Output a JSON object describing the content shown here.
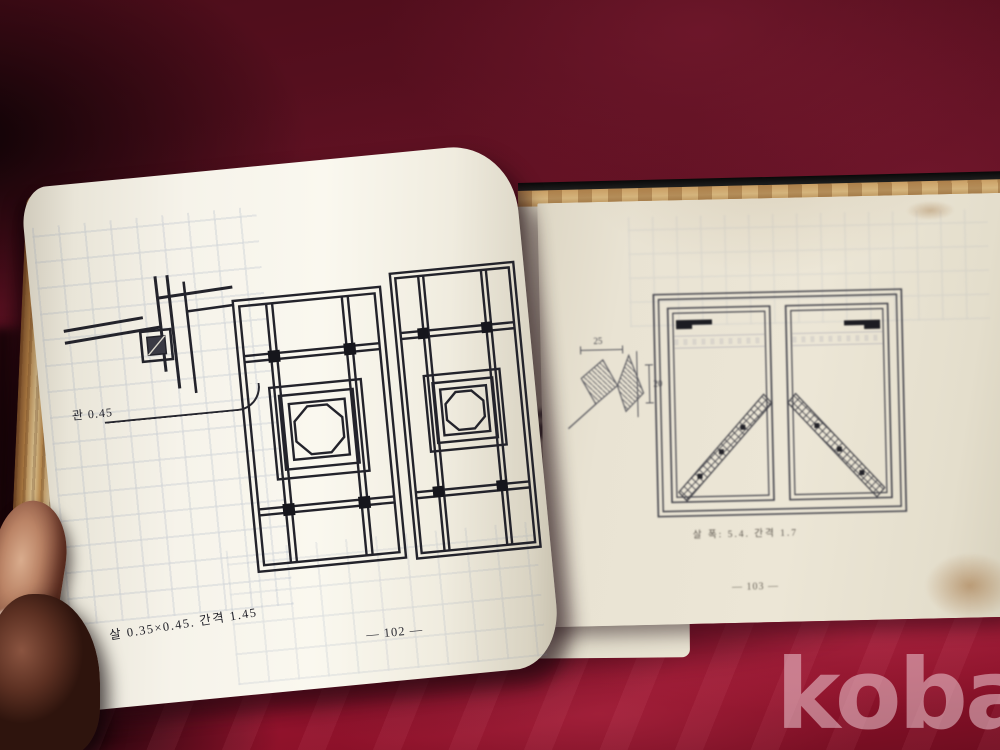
{
  "watermark": {
    "label": "kobay"
  },
  "book": {
    "left_page": {
      "detail_label": "관 0.45",
      "caption": "살 0.35×0.45. 간격 1.45",
      "page_number": "— 102 —"
    },
    "right_page": {
      "dim_top": "25",
      "dim_side": "20",
      "caption": "살 폭: 5.4. 간격 1.7",
      "page_number": "— 103 —"
    }
  },
  "colors": {
    "fabric_dark": "#4c0d1a",
    "fabric_bright": "#9d1532",
    "page_cream": "#f6f3ea",
    "ink": "#26262e",
    "tan_edge": "#c89d63",
    "cover_black": "#161616",
    "watermark_pink": "#ecccd4"
  }
}
